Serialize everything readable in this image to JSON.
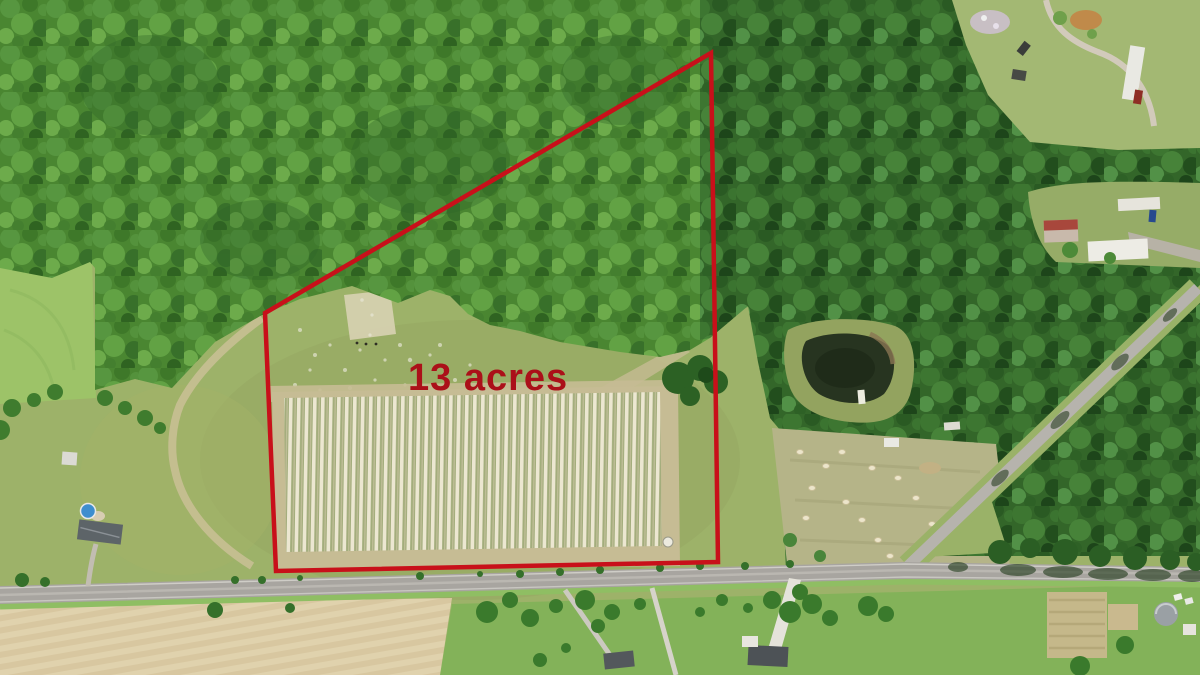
{
  "image": {
    "type": "aerial-drone-photograph",
    "subject": "Rural land parcel bordered by forest and a country road, with property boundary overlay"
  },
  "annotation": {
    "label": "13 acres",
    "label_color": "#ab1019",
    "boundary_color": "#c8101a",
    "boundary_points": "711,53 265,313 276,571 718,562",
    "boundary_stroke_width": "4.5"
  },
  "palette": {
    "forest_bright_green": "#4a8631",
    "forest_dark_green": "#336629",
    "meadow_green": "#9db269",
    "pasture_bright_green": "#9dc368",
    "crop_row_light": "#ece7d1",
    "crop_row_gap": "#a3ad7c",
    "dirt_tan": "#c6bc94",
    "road_gray": "#a8a5a0",
    "plowed_field_tan": "#d8c7a0",
    "lawn_green": "#83b259",
    "pond_dark": "#273420",
    "pool_blue": "#3e8ecf"
  },
  "features": [
    "dense forest canopy (north and east)",
    "open meadow inside outlined parcel",
    "planted nursery rows",
    "farm pond",
    "hay-bale field",
    "main paved road (bottom)",
    "side road branching northeast",
    "farmhouses with driveways",
    "swimming pool",
    "plowed tan field (bottom left)"
  ]
}
